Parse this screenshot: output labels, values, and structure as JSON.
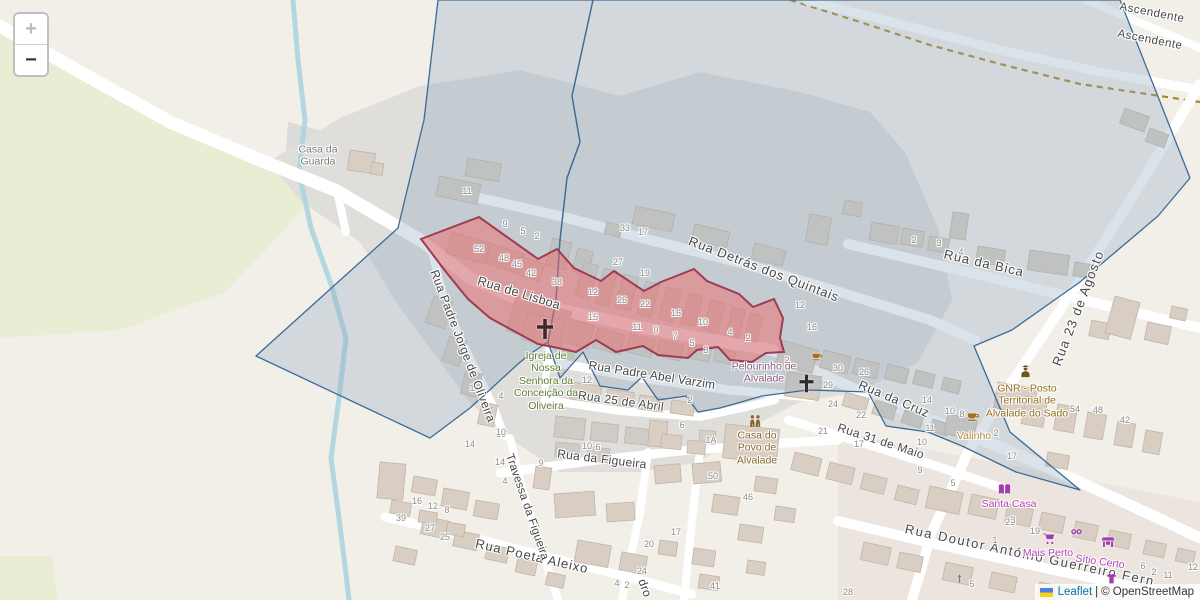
{
  "controls": {
    "zoom_in_label": "+",
    "zoom_out_label": "−"
  },
  "attribution": {
    "leaflet_link": "Leaflet",
    "separator": "|",
    "copyright": "© OpenStreetMap"
  },
  "colors": {
    "selection_fill": "#ef6666",
    "selection_stroke": "#9e3c55",
    "zone_fill": "#8fa7bd",
    "zone_stroke": "#3c6b99",
    "water": "#aad4e0",
    "road": "#ffffff",
    "greenery": "#e9edd3",
    "residential": "#dfdedb",
    "building_fill": "#d8cec3",
    "building_stroke": "#c3b5a5",
    "path_dashed": "#a8852e"
  },
  "street_labels": [
    {
      "text": "Rua de Lisboa",
      "x": 519,
      "y": 293,
      "rot": 17,
      "size": 12.5,
      "ls": 0.4
    },
    {
      "text": "Rua Detrás dos Quintais",
      "x": 764,
      "y": 269,
      "rot": 21,
      "size": 13,
      "ls": 0.8
    },
    {
      "text": "Rua da Bica",
      "x": 984,
      "y": 263,
      "rot": 13,
      "size": 13,
      "ls": 1
    },
    {
      "text": "Rua 23 de Agosto",
      "x": 1078,
      "y": 308,
      "rot": -69,
      "size": 13,
      "ls": 1.2
    },
    {
      "text": "Rua Padre Abel Varzim",
      "x": 652,
      "y": 375,
      "rot": 9,
      "size": 12,
      "ls": 0.2
    },
    {
      "text": "Rua 25 de Abril",
      "x": 621,
      "y": 401,
      "rot": 8,
      "size": 12,
      "ls": 0.3
    },
    {
      "text": "Rua da Figueira",
      "x": 602,
      "y": 459,
      "rot": 7,
      "size": 12,
      "ls": 0.3
    },
    {
      "text": "Rua da Cruz",
      "x": 894,
      "y": 399,
      "rot": 23,
      "size": 12.5,
      "ls": 0.5
    },
    {
      "text": "Rua 31 de Maio",
      "x": 881,
      "y": 441,
      "rot": 18,
      "size": 12,
      "ls": 0.4
    },
    {
      "text": "Rua Doutor António Guerreiro Fern",
      "x": 1030,
      "y": 555,
      "rot": 12,
      "size": 13,
      "ls": 1.6
    },
    {
      "text": "Rua Poeta Aleixo",
      "x": 532,
      "y": 556,
      "rot": 13,
      "size": 13,
      "ls": 1
    },
    {
      "text": "Travessa da Figueira",
      "x": 527,
      "y": 507,
      "rot": 71,
      "size": 11.5,
      "ls": 0.2
    },
    {
      "text": "Rua Padre Jorge de Oliveira",
      "x": 463,
      "y": 346,
      "rot": 69,
      "size": 12,
      "ls": 0.4
    },
    {
      "text": "dro",
      "x": 645,
      "y": 588,
      "rot": 70,
      "size": 12,
      "ls": 0.3
    },
    {
      "text": "Ascendente",
      "x": 1152,
      "y": 13,
      "rot": 11,
      "size": 11.5,
      "ls": 0.5
    },
    {
      "text": "Ascendente",
      "x": 1150,
      "y": 40,
      "rot": 11,
      "size": 11.5,
      "ls": 0.5
    }
  ],
  "poi_labels": [
    {
      "text": "Casa da Guarda",
      "x": 318,
      "y": 156,
      "w": 70,
      "color": "#7d7d7d"
    },
    {
      "text": "Igreja de Nossa Senhora da Conceição da Oliveira",
      "x": 546,
      "y": 381,
      "w": 72,
      "color": "#5d7c33"
    },
    {
      "text": "Pelourinho de Alvalade",
      "x": 764,
      "y": 373,
      "w": 84,
      "color": "#8d5c80"
    },
    {
      "text": "Casa do Povo de Alvalade",
      "x": 757,
      "y": 448,
      "w": 64,
      "color": "#8a6a2c"
    },
    {
      "text": "GNR - Posto Territorial de Alvalade do Sado",
      "x": 1027,
      "y": 401,
      "w": 88,
      "color": "#93701d"
    },
    {
      "text": "Valinho",
      "x": 974,
      "y": 436,
      "w": 60,
      "color": "#bb8b3a"
    },
    {
      "text": "Santa Casa",
      "x": 1009,
      "y": 504,
      "w": 90,
      "color": "#b545b5"
    },
    {
      "text": "Mais Perto",
      "x": 1048,
      "y": 553,
      "w": 80,
      "color": "#b545b5"
    },
    {
      "text": "Sítio Certo",
      "x": 1100,
      "y": 562,
      "w": 84,
      "color": "#b545b5",
      "rot": 8
    }
  ],
  "house_numbers": [
    {
      "t": "11",
      "x": 467,
      "y": 191
    },
    {
      "t": "9",
      "x": 505,
      "y": 224
    },
    {
      "t": "5",
      "x": 523,
      "y": 231
    },
    {
      "t": "2",
      "x": 537,
      "y": 236
    },
    {
      "t": "52",
      "x": 479,
      "y": 249
    },
    {
      "t": "48",
      "x": 504,
      "y": 258
    },
    {
      "t": "45",
      "x": 517,
      "y": 264
    },
    {
      "t": "42",
      "x": 531,
      "y": 273
    },
    {
      "t": "38",
      "x": 557,
      "y": 282
    },
    {
      "t": "12",
      "x": 593,
      "y": 292
    },
    {
      "t": "26",
      "x": 622,
      "y": 300
    },
    {
      "t": "22",
      "x": 645,
      "y": 304
    },
    {
      "t": "16",
      "x": 676,
      "y": 313
    },
    {
      "t": "10",
      "x": 703,
      "y": 322
    },
    {
      "t": "4",
      "x": 730,
      "y": 332
    },
    {
      "t": "2",
      "x": 748,
      "y": 338
    },
    {
      "t": "15",
      "x": 593,
      "y": 317
    },
    {
      "t": "11",
      "x": 637,
      "y": 327
    },
    {
      "t": "9",
      "x": 656,
      "y": 330
    },
    {
      "t": "7",
      "x": 675,
      "y": 336
    },
    {
      "t": "5",
      "x": 692,
      "y": 343
    },
    {
      "t": "3",
      "x": 706,
      "y": 350
    },
    {
      "t": "19",
      "x": 645,
      "y": 273
    },
    {
      "t": "33",
      "x": 625,
      "y": 228
    },
    {
      "t": "17",
      "x": 643,
      "y": 232
    },
    {
      "t": "27",
      "x": 618,
      "y": 262
    },
    {
      "t": "12",
      "x": 800,
      "y": 305
    },
    {
      "t": "16",
      "x": 812,
      "y": 327
    },
    {
      "t": "2",
      "x": 787,
      "y": 360
    },
    {
      "t": "30",
      "x": 838,
      "y": 368
    },
    {
      "t": "26",
      "x": 864,
      "y": 372
    },
    {
      "t": "29",
      "x": 828,
      "y": 385
    },
    {
      "t": "24",
      "x": 833,
      "y": 404
    },
    {
      "t": "22",
      "x": 861,
      "y": 415
    },
    {
      "t": "21",
      "x": 823,
      "y": 431
    },
    {
      "t": "17",
      "x": 859,
      "y": 444
    },
    {
      "t": "14",
      "x": 927,
      "y": 400
    },
    {
      "t": "10",
      "x": 950,
      "y": 411
    },
    {
      "t": "8",
      "x": 962,
      "y": 414
    },
    {
      "t": "11",
      "x": 930,
      "y": 428
    },
    {
      "t": "10",
      "x": 922,
      "y": 442
    },
    {
      "t": "9",
      "x": 920,
      "y": 470
    },
    {
      "t": "5",
      "x": 953,
      "y": 483
    },
    {
      "t": "2",
      "x": 996,
      "y": 433
    },
    {
      "t": "54",
      "x": 1075,
      "y": 409
    },
    {
      "t": "48",
      "x": 1098,
      "y": 410
    },
    {
      "t": "42",
      "x": 1125,
      "y": 420
    },
    {
      "t": "17",
      "x": 1012,
      "y": 456
    },
    {
      "t": "2",
      "x": 914,
      "y": 240
    },
    {
      "t": "3",
      "x": 939,
      "y": 243
    },
    {
      "t": "4",
      "x": 961,
      "y": 252
    },
    {
      "t": "10",
      "x": 501,
      "y": 434
    },
    {
      "t": "14",
      "x": 500,
      "y": 462
    },
    {
      "t": "9",
      "x": 541,
      "y": 463
    },
    {
      "t": "4",
      "x": 505,
      "y": 481
    },
    {
      "t": "16",
      "x": 417,
      "y": 501
    },
    {
      "t": "12",
      "x": 433,
      "y": 506
    },
    {
      "t": "8",
      "x": 447,
      "y": 510
    },
    {
      "t": "39",
      "x": 401,
      "y": 518
    },
    {
      "t": "27",
      "x": 430,
      "y": 528
    },
    {
      "t": "25",
      "x": 445,
      "y": 537
    },
    {
      "t": "12",
      "x": 587,
      "y": 380
    },
    {
      "t": "10",
      "x": 587,
      "y": 446
    },
    {
      "t": "6",
      "x": 598,
      "y": 447
    },
    {
      "t": "14",
      "x": 470,
      "y": 444
    },
    {
      "t": "4",
      "x": 501,
      "y": 396
    },
    {
      "t": "10",
      "x": 501,
      "y": 432
    },
    {
      "t": "1",
      "x": 472,
      "y": 388
    },
    {
      "t": "1A",
      "x": 711,
      "y": 440
    },
    {
      "t": "50",
      "x": 713,
      "y": 476
    },
    {
      "t": "46",
      "x": 748,
      "y": 497
    },
    {
      "t": "20",
      "x": 649,
      "y": 544
    },
    {
      "t": "24",
      "x": 642,
      "y": 571
    },
    {
      "t": "4",
      "x": 617,
      "y": 583
    },
    {
      "t": "2",
      "x": 627,
      "y": 585
    },
    {
      "t": "41",
      "x": 715,
      "y": 586
    },
    {
      "t": "17",
      "x": 676,
      "y": 532
    },
    {
      "t": "23",
      "x": 1010,
      "y": 522
    },
    {
      "t": "19",
      "x": 1035,
      "y": 531
    },
    {
      "t": "1",
      "x": 995,
      "y": 540
    },
    {
      "t": "5",
      "x": 972,
      "y": 584
    },
    {
      "t": "28",
      "x": 848,
      "y": 592
    },
    {
      "t": "3",
      "x": 1013,
      "y": 520
    },
    {
      "t": "6",
      "x": 1143,
      "y": 566
    },
    {
      "t": "2",
      "x": 1154,
      "y": 572
    },
    {
      "t": "11",
      "x": 1168,
      "y": 575
    },
    {
      "t": "12",
      "x": 1193,
      "y": 567
    },
    {
      "t": "6",
      "x": 682,
      "y": 425
    },
    {
      "t": "2",
      "x": 690,
      "y": 400
    }
  ],
  "icons": [
    {
      "name": "church-cross-icon",
      "sym": "cross",
      "x": 545,
      "y": 329,
      "size": 24,
      "color": "#41262c"
    },
    {
      "name": "church-cross-icon",
      "sym": "cross",
      "x": 806,
      "y": 383,
      "size": 21,
      "color": "#2d2d2d"
    },
    {
      "name": "cafe-cup-icon",
      "sym": "cup",
      "x": 817,
      "y": 356,
      "size": 13,
      "color": "#aa6e22"
    },
    {
      "name": "cafe-cup-icon",
      "sym": "cup",
      "x": 973,
      "y": 416,
      "size": 15,
      "color": "#aa6e22"
    },
    {
      "name": "community-people-icon",
      "sym": "people",
      "x": 755,
      "y": 421,
      "size": 16,
      "color": "#8a6a2c"
    },
    {
      "name": "police-officer-icon",
      "sym": "police",
      "x": 1025,
      "y": 371,
      "size": 15,
      "color": "#6d5418"
    },
    {
      "name": "library-book-icon",
      "sym": "book",
      "x": 1004,
      "y": 489,
      "size": 15,
      "color": "#a43bb0"
    },
    {
      "name": "supermarket-cart-icon",
      "sym": "cart",
      "x": 1049,
      "y": 538,
      "size": 14,
      "color": "#a43bb0"
    },
    {
      "name": "shoe-shop-icon",
      "sym": "shoes",
      "x": 1076,
      "y": 531,
      "size": 13,
      "color": "#a43bb0"
    },
    {
      "name": "marketplace-stall-icon",
      "sym": "stall",
      "x": 1108,
      "y": 542,
      "size": 14,
      "color": "#a43bb0"
    },
    {
      "name": "clothes-shop-icon",
      "sym": "shirt",
      "x": 1111,
      "y": 578,
      "size": 13,
      "color": "#a43bb0"
    },
    {
      "name": "oneway-arrow-icon",
      "sym": "arrow",
      "x": 959,
      "y": 578,
      "size": 11,
      "color": "#6b7f9e"
    }
  ]
}
